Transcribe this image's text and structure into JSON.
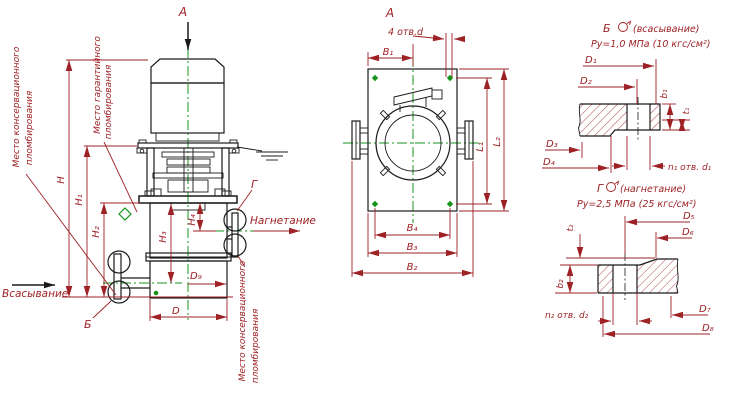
{
  "colors": {
    "outline": "#1a1a1a",
    "dimension": "#9e2125",
    "centerline": "#17941c",
    "background": "#ffffff"
  },
  "left_view": {
    "view_label": "А",
    "suction_label": "Всасывание",
    "discharge_label": "Нагнетание",
    "flange_suction_ref": "Б",
    "flange_discharge_ref": "Г",
    "seal_notes": {
      "conservation_line1": "Место консервационного",
      "conservation_line2": "пломбирования",
      "warranty_line1": "Место гарантийного",
      "warranty_line2": "пломбирования"
    },
    "dims": {
      "H": "H",
      "H1": "H₁",
      "H2": "H₂",
      "H3": "H₃",
      "H4": "H₄",
      "D": "D",
      "D9": "D₉"
    }
  },
  "plan_view": {
    "view_label": "А",
    "holes_note": "4 отв.d",
    "dims": {
      "B1": "B₁",
      "B2": "B₂",
      "B3": "B₃",
      "B4": "B₄",
      "L1": "L₁",
      "L2": "L₂"
    }
  },
  "flange_suction": {
    "ref": "Б",
    "type_note": "(всасывание)",
    "pressure": "Ру=1,0 МПа (10 кгс/см²)",
    "holes_note": "n₁ отв. d₁",
    "dims": {
      "D1": "D₁",
      "D2": "D₂",
      "D3": "D₃",
      "D4": "D₄",
      "b1": "b₁",
      "t1": "t₁"
    }
  },
  "flange_discharge": {
    "ref": "Г",
    "type_note": "(нагнетание)",
    "pressure": "Ру=2,5 МПа (25 кгс/см²)",
    "holes_note": "n₂ отв. d₂",
    "dims": {
      "D5": "D₅",
      "D6": "D₆",
      "D7": "D₇",
      "D8": "D₈",
      "b2": "b₂",
      "t2": "t₂"
    }
  }
}
